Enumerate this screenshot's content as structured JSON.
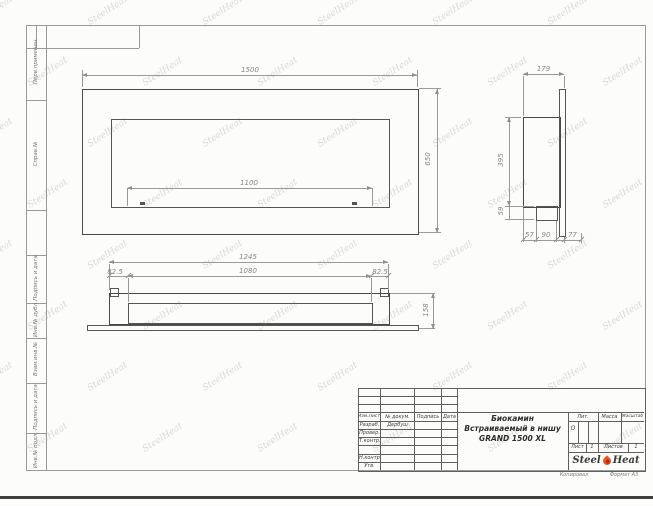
{
  "watermark": {
    "text": "SteelHeat"
  },
  "left_strip": {
    "items": [
      "Перв.применен.",
      "Справ.№",
      "Подпись и дата",
      "Инв.№ дубл.",
      "Взам.инв.№",
      "Подпись и дата",
      "Инв.№ подл."
    ]
  },
  "front_view": {
    "width": "1500",
    "height": "650",
    "opening_width": "1100"
  },
  "side_view": {
    "depth": "179",
    "height": "395",
    "burner_drop": "59",
    "bottom_dims": [
      "57",
      "90",
      "77"
    ]
  },
  "bottom_view": {
    "overall": "1245",
    "opening": "1080",
    "margin_left": "82.5",
    "margin_right": "82.5",
    "height": "158"
  },
  "title_block": {
    "revision_header": [
      "Изм.Лист",
      "№ докум.",
      "Подпись",
      "Дата"
    ],
    "roles": [
      {
        "label": "Разраб.",
        "name": "Дербуш"
      },
      {
        "label": "Провер.",
        "name": ""
      },
      {
        "label": "Т.контр.",
        "name": ""
      },
      {
        "label": "Н.контр.",
        "name": ""
      },
      {
        "label": "Утв.",
        "name": ""
      }
    ],
    "title_line1": "Биокамин",
    "title_line2": "Встраиваемый в нишу",
    "title_line3": "GRAND 1500 XL",
    "lit_label": "Лит.",
    "lit_value": "О",
    "mass_label": "Масса",
    "scale_label": "Масштаб",
    "sheet_label": "Лист",
    "sheet_number": "1",
    "sheets_label": "Листов",
    "sheets_total": "1",
    "brand_left": "Steel",
    "brand_right": "Heat",
    "copy_label": "Копировал",
    "format_label": "Формат А3"
  },
  "colors": {
    "flame_orange": "#e65c1f",
    "flame_red": "#c2271c",
    "object_line": "#4a4a4a",
    "dim_line": "#8f8f8f"
  }
}
